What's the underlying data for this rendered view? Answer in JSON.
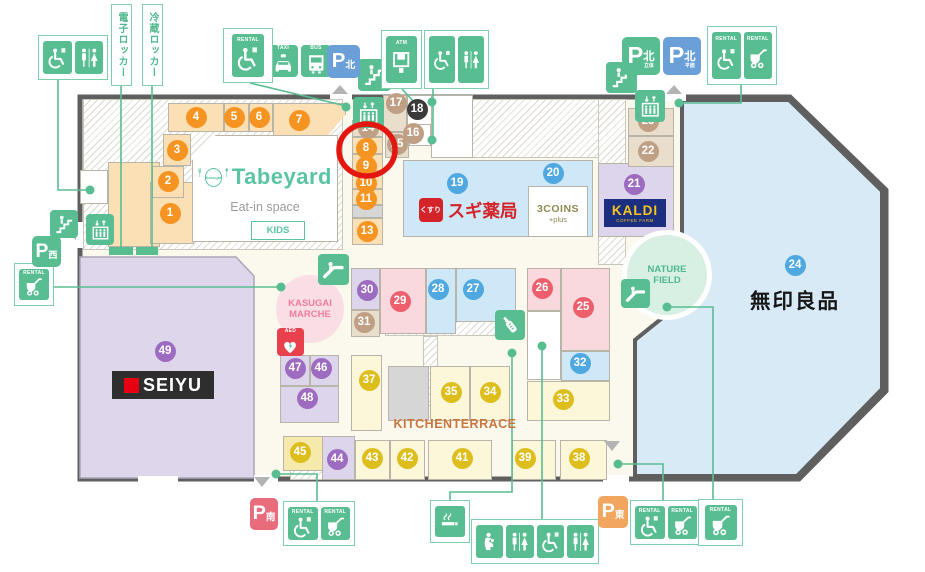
{
  "title": "Kasugai shopping center floor map",
  "highlighted_unit": "8",
  "texts": {
    "rental": "RENTAL",
    "taxi": "TAXI",
    "bus": "BUS",
    "atm": "ATM",
    "aed": "AED",
    "p": "P",
    "denshi_locker": "電子ロッカー",
    "reizo_locker": "冷蔵ロッカー",
    "kitchen_terrace": "KITCHENTERRACE",
    "muji": "無印良品",
    "marche1": "KASUGAI",
    "marche2": "MARCHE",
    "nature1": "NATURE",
    "nature2": "FIELD",
    "tabeyard_brand": "Tabeyard",
    "tabeyard_logo": "Kasugai",
    "tabeyard_sub": "Eat-in space",
    "tabeyard_kids": "KIDS",
    "sugi": "スギ薬局",
    "sugi_logo": "くすり",
    "coins": "3COINS",
    "coins_plus": "+plus",
    "kaldi": "KALDI",
    "kaldi_sub": "COFFEE FARM",
    "seiyu": "SEIYU"
  },
  "palette": {
    "green": "#59bd92",
    "greenBorder": "#7ecfae",
    "blueP": "#6a9fd8",
    "pinkP": "#e96c7c",
    "orangeP": "#f2a55f",
    "cream": "#fbf9ee",
    "wall": "#5f5f5f",
    "pe": "#fbdfb5",
    "ta": "#e9ddcc",
    "bl": "#cfe8f7",
    "pi": "#f9d9de",
    "la": "#ddd5ec",
    "ye": "#fcf7d9",
    "dy": "#f6e9ac",
    "gr": "#d6d6d6",
    "wh": "#ffffff",
    "mujiBlue": "#d7eaf6",
    "seiyuLav": "#ded7eb",
    "orange": "#f59421",
    "tan": "#bfa084",
    "blue": "#4fa8e0",
    "pink": "#ed5f6d",
    "purple": "#9d6cc0",
    "yellow": "#ddbe1c",
    "black": "#3a3a3a",
    "ringRed": "#e3170f",
    "aedRed": "#e8404d",
    "sugiRed": "#d5232a",
    "kaldiNavy": "#1b2e80",
    "kaldiYellow": "#f5c520",
    "coinsOlive": "#8f8a52",
    "kitchenBrown": "#c9773f",
    "marchePink": "#f07ca0",
    "natureGreen": "#4fb88d",
    "tabeTeal": "#5bc4a4",
    "seiyuRed": "#e60012",
    "marcheBg": "#f9dee6",
    "natureBg": "#d8efe3"
  },
  "shapes": {
    "outline": "80,97 790,97 886,190 886,391 799,479 80,479",
    "muji": "682,100 789,100 882,191 882,389 797,476 635,476 635,340 682,302",
    "seiyu": "80,257 236,257 254,276 254,478 80,478"
  },
  "units": [
    {
      "n": "1",
      "x": 170,
      "y": 213,
      "c": "orange"
    },
    {
      "n": "2",
      "x": 168,
      "y": 181,
      "c": "orange"
    },
    {
      "n": "3",
      "x": 177,
      "y": 150,
      "c": "orange"
    },
    {
      "n": "4",
      "x": 196,
      "y": 117,
      "c": "orange"
    },
    {
      "n": "5",
      "x": 234,
      "y": 117,
      "c": "orange"
    },
    {
      "n": "6",
      "x": 259,
      "y": 117,
      "c": "orange"
    },
    {
      "n": "7",
      "x": 299,
      "y": 120,
      "c": "orange"
    },
    {
      "n": "14",
      "x": 368,
      "y": 128,
      "c": "tan"
    },
    {
      "n": "8",
      "x": 366,
      "y": 148,
      "c": "orange"
    },
    {
      "n": "9",
      "x": 366,
      "y": 166,
      "c": "orange"
    },
    {
      "n": "10",
      "x": 366,
      "y": 183,
      "c": "orange"
    },
    {
      "n": "11",
      "x": 366,
      "y": 199,
      "c": "orange"
    },
    {
      "n": "13",
      "x": 367,
      "y": 231,
      "c": "orange"
    },
    {
      "n": "15",
      "x": 397,
      "y": 144,
      "c": "tan"
    },
    {
      "n": "16",
      "x": 413,
      "y": 133,
      "c": "tan"
    },
    {
      "n": "17",
      "x": 396,
      "y": 103,
      "c": "tan"
    },
    {
      "n": "18",
      "x": 417,
      "y": 109,
      "c": "black"
    },
    {
      "n": "19",
      "x": 457,
      "y": 183,
      "c": "blue"
    },
    {
      "n": "20",
      "x": 553,
      "y": 173,
      "c": "blue"
    },
    {
      "n": "21",
      "x": 634,
      "y": 184,
      "c": "purple"
    },
    {
      "n": "22",
      "x": 648,
      "y": 151,
      "c": "tan"
    },
    {
      "n": "23",
      "x": 648,
      "y": 121,
      "c": "tan"
    },
    {
      "n": "24",
      "x": 795,
      "y": 265,
      "c": "blue"
    },
    {
      "n": "25",
      "x": 583,
      "y": 307,
      "c": "pink"
    },
    {
      "n": "26",
      "x": 542,
      "y": 288,
      "c": "pink"
    },
    {
      "n": "27",
      "x": 473,
      "y": 289,
      "c": "blue"
    },
    {
      "n": "28",
      "x": 438,
      "y": 289,
      "c": "blue"
    },
    {
      "n": "29",
      "x": 400,
      "y": 301,
      "c": "pink"
    },
    {
      "n": "30",
      "x": 367,
      "y": 290,
      "c": "purple"
    },
    {
      "n": "31",
      "x": 364,
      "y": 322,
      "c": "tan"
    },
    {
      "n": "32",
      "x": 580,
      "y": 363,
      "c": "blue"
    },
    {
      "n": "33",
      "x": 563,
      "y": 399,
      "c": "yellow"
    },
    {
      "n": "34",
      "x": 490,
      "y": 392,
      "c": "yellow"
    },
    {
      "n": "35",
      "x": 451,
      "y": 392,
      "c": "yellow"
    },
    {
      "n": "37",
      "x": 369,
      "y": 380,
      "c": "yellow"
    },
    {
      "n": "38",
      "x": 579,
      "y": 458,
      "c": "yellow"
    },
    {
      "n": "39",
      "x": 525,
      "y": 458,
      "c": "yellow"
    },
    {
      "n": "41",
      "x": 462,
      "y": 458,
      "c": "yellow"
    },
    {
      "n": "42",
      "x": 407,
      "y": 458,
      "c": "yellow"
    },
    {
      "n": "43",
      "x": 372,
      "y": 458,
      "c": "yellow"
    },
    {
      "n": "44",
      "x": 337,
      "y": 459,
      "c": "purple"
    },
    {
      "n": "45",
      "x": 300,
      "y": 452,
      "c": "yellow"
    },
    {
      "n": "46",
      "x": 321,
      "y": 368,
      "c": "purple"
    },
    {
      "n": "47",
      "x": 295,
      "y": 368,
      "c": "purple"
    },
    {
      "n": "48",
      "x": 307,
      "y": 398,
      "c": "purple"
    },
    {
      "n": "49",
      "x": 165,
      "y": 351,
      "c": "purple"
    }
  ],
  "blocks": [
    [
      108,
      162,
      52,
      85,
      "pe",
      ""
    ],
    [
      150,
      182,
      44,
      62,
      "pe",
      ""
    ],
    [
      152,
      166,
      32,
      32,
      "pe",
      ""
    ],
    [
      163,
      134,
      28,
      32,
      "pe",
      ""
    ],
    [
      168,
      103,
      56,
      29,
      "pe",
      ""
    ],
    [
      224,
      103,
      25,
      29,
      "pe",
      ""
    ],
    [
      249,
      103,
      24,
      29,
      "pe",
      ""
    ],
    [
      273,
      103,
      73,
      37,
      "pe",
      "slant"
    ],
    [
      352,
      120,
      31,
      17,
      "ta",
      ""
    ],
    [
      352,
      137,
      31,
      17,
      "pe",
      ""
    ],
    [
      352,
      154,
      31,
      17,
      "pe",
      ""
    ],
    [
      352,
      171,
      31,
      18,
      "pe",
      ""
    ],
    [
      352,
      189,
      31,
      16,
      "pe",
      ""
    ],
    [
      352,
      205,
      31,
      13,
      "gr",
      ""
    ],
    [
      352,
      218,
      31,
      27,
      "pe",
      ""
    ],
    [
      383,
      95,
      24,
      37,
      "ta",
      ""
    ],
    [
      407,
      95,
      31,
      37,
      "wh",
      ""
    ],
    [
      360,
      110,
      20,
      14,
      "wh",
      ""
    ],
    [
      385,
      132,
      24,
      26,
      "ta",
      ""
    ],
    [
      409,
      124,
      22,
      22,
      "wh",
      ""
    ],
    [
      431,
      95,
      42,
      63,
      "wh",
      ""
    ],
    [
      403,
      160,
      190,
      77,
      "bl",
      ""
    ],
    [
      528,
      186,
      60,
      51,
      "wh",
      ""
    ],
    [
      598,
      163,
      76,
      74,
      "la",
      ""
    ],
    [
      628,
      108,
      46,
      28,
      "ta",
      ""
    ],
    [
      628,
      136,
      46,
      31,
      "ta",
      ""
    ],
    [
      80,
      170,
      28,
      34,
      "wh",
      ""
    ],
    [
      351,
      268,
      29,
      42,
      "la",
      ""
    ],
    [
      351,
      310,
      29,
      27,
      "ta",
      ""
    ],
    [
      380,
      268,
      46,
      66,
      "pi",
      ""
    ],
    [
      426,
      268,
      30,
      66,
      "bl",
      ""
    ],
    [
      456,
      268,
      60,
      54,
      "bl",
      ""
    ],
    [
      527,
      268,
      34,
      43,
      "pi",
      ""
    ],
    [
      561,
      268,
      49,
      83,
      "pi",
      ""
    ],
    [
      527,
      311,
      34,
      69,
      "wh",
      ""
    ],
    [
      561,
      351,
      49,
      30,
      "bl",
      ""
    ],
    [
      527,
      381,
      83,
      40,
      "ye",
      ""
    ],
    [
      351,
      355,
      31,
      76,
      "ye",
      ""
    ],
    [
      388,
      366,
      41,
      55,
      "gr",
      ""
    ],
    [
      430,
      366,
      40,
      55,
      "ye",
      ""
    ],
    [
      470,
      366,
      40,
      55,
      "ye",
      ""
    ],
    [
      283,
      436,
      47,
      35,
      "dy",
      ""
    ],
    [
      322,
      436,
      33,
      44,
      "la",
      ""
    ],
    [
      355,
      440,
      35,
      40,
      "ye",
      ""
    ],
    [
      390,
      440,
      35,
      40,
      "ye",
      ""
    ],
    [
      428,
      440,
      64,
      40,
      "ye",
      ""
    ],
    [
      512,
      440,
      44,
      40,
      "ye",
      ""
    ],
    [
      560,
      440,
      47,
      40,
      "ye",
      ""
    ],
    [
      280,
      355,
      30,
      31,
      "la",
      ""
    ],
    [
      310,
      355,
      29,
      31,
      "la",
      ""
    ],
    [
      280,
      386,
      59,
      37,
      "la",
      ""
    ],
    [
      192,
      135,
      146,
      107,
      "wh",
      "tb"
    ]
  ],
  "hatches": [
    [
      83,
      99,
      260,
      151
    ],
    [
      432,
      99,
      190,
      59
    ],
    [
      598,
      99,
      28,
      166
    ],
    [
      385,
      308,
      122,
      28
    ],
    [
      423,
      336,
      15,
      70
    ],
    [
      290,
      467,
      127,
      13
    ],
    [
      196,
      224,
      30,
      16
    ]
  ],
  "gaps": [
    [
      330,
      93,
      22,
      8
    ],
    [
      664,
      93,
      22,
      8
    ],
    [
      74,
      222,
      10,
      26
    ],
    [
      254,
      475,
      24,
      9
    ],
    [
      603,
      475,
      26,
      9
    ],
    [
      138,
      476,
      40,
      6
    ]
  ],
  "lockers": [
    [
      109,
      247,
      24,
      8
    ],
    [
      136,
      247,
      22,
      8
    ]
  ],
  "parkings": [
    {
      "x": 327,
      "y": 45,
      "w": 33,
      "h": 33,
      "bg": "#6a9fd8",
      "kanji": "北",
      "sub": ""
    },
    {
      "x": 622,
      "y": 37,
      "w": 38,
      "h": 38,
      "bg": "#59bd92",
      "kanji": "北",
      "sub": "立体"
    },
    {
      "x": 663,
      "y": 37,
      "w": 38,
      "h": 38,
      "bg": "#6a9fd8",
      "kanji": "北",
      "sub": "平面"
    },
    {
      "x": 32,
      "y": 236,
      "w": 29,
      "h": 31,
      "bg": "#59bd92",
      "kanji": "西",
      "sub": ""
    },
    {
      "x": 250,
      "y": 498,
      "w": 28,
      "h": 32,
      "bg": "#e96c7c",
      "kanji": "南",
      "sub": ""
    },
    {
      "x": 598,
      "y": 496,
      "w": 30,
      "h": 32,
      "bg": "#f2a55f",
      "kanji": "東",
      "sub": ""
    }
  ],
  "icons": [
    {
      "g": "stairs",
      "x": 358,
      "y": 59,
      "w": 33,
      "h": 32,
      "name": "stairs-icon"
    },
    {
      "g": "stairs",
      "x": 606,
      "y": 62,
      "w": 31,
      "h": 31,
      "name": "stairs-icon"
    },
    {
      "g": "stairs",
      "x": 50,
      "y": 210,
      "w": 28,
      "h": 28,
      "name": "stairs-icon"
    },
    {
      "g": "escalator",
      "x": 318,
      "y": 254,
      "w": 31,
      "h": 31,
      "name": "escalator-icon"
    },
    {
      "g": "escalator",
      "x": 621,
      "y": 279,
      "w": 29,
      "h": 29,
      "name": "escalator-icon"
    },
    {
      "g": "elevator",
      "x": 353,
      "y": 97,
      "w": 31,
      "h": 31,
      "name": "elevator-icon"
    },
    {
      "g": "elevator",
      "x": 635,
      "y": 90,
      "w": 30,
      "h": 32,
      "name": "elevator-icon"
    },
    {
      "g": "elevator",
      "x": 86,
      "y": 214,
      "w": 28,
      "h": 31,
      "name": "elevator-icon"
    },
    {
      "g": "taxi",
      "x": 268,
      "y": 45,
      "w": 30,
      "h": 32,
      "label": "taxi",
      "name": "taxi-icon"
    },
    {
      "g": "bus",
      "x": 301,
      "y": 45,
      "w": 30,
      "h": 32,
      "label": "bus",
      "name": "bus-icon"
    },
    {
      "g": "bottle",
      "x": 495,
      "y": 310,
      "w": 30,
      "h": 30,
      "name": "nursing-bottle-icon"
    }
  ],
  "groups": [
    {
      "x": 38,
      "y": 35,
      "w": 70,
      "h": 45,
      "items": [
        {
          "k": "plain",
          "g": "wheelchair"
        },
        {
          "k": "plain",
          "g": "toilets"
        }
      ]
    },
    {
      "x": 223,
      "y": 28,
      "w": 50,
      "h": 55,
      "items": [
        {
          "k": "rental",
          "g": "wheelchair"
        }
      ]
    },
    {
      "x": 381,
      "y": 30,
      "w": 41,
      "h": 59,
      "items": [
        {
          "k": "atm",
          "g": "atm"
        }
      ]
    },
    {
      "x": 424,
      "y": 30,
      "w": 65,
      "h": 59,
      "items": [
        {
          "k": "plain",
          "g": "wheelchair"
        },
        {
          "k": "plain",
          "g": "toilets"
        }
      ]
    },
    {
      "x": 707,
      "y": 26,
      "w": 70,
      "h": 59,
      "items": [
        {
          "k": "rental",
          "g": "wheelchair"
        },
        {
          "k": "rental",
          "g": "stroller"
        }
      ]
    },
    {
      "x": 14,
      "y": 263,
      "w": 40,
      "h": 43,
      "items": [
        {
          "k": "rental",
          "g": "stroller"
        }
      ]
    },
    {
      "x": 283,
      "y": 501,
      "w": 72,
      "h": 45,
      "items": [
        {
          "k": "rental",
          "g": "wheelchair"
        },
        {
          "k": "rental",
          "g": "stroller"
        }
      ]
    },
    {
      "x": 430,
      "y": 500,
      "w": 40,
      "h": 43,
      "items": [
        {
          "k": "plain",
          "g": "smoking"
        }
      ]
    },
    {
      "x": 471,
      "y": 519,
      "w": 128,
      "h": 45,
      "items": [
        {
          "k": "plain",
          "g": "nursing"
        },
        {
          "k": "plain",
          "g": "toilets"
        },
        {
          "k": "plain",
          "g": "wheelchair"
        },
        {
          "k": "plain",
          "g": "toilets"
        }
      ]
    },
    {
      "x": 630,
      "y": 500,
      "w": 72,
      "h": 45,
      "items": [
        {
          "k": "rental",
          "g": "wheelchair"
        },
        {
          "k": "rental",
          "g": "stroller"
        }
      ]
    },
    {
      "x": 698,
      "y": 499,
      "w": 45,
      "h": 47,
      "items": [
        {
          "k": "rental",
          "g": "stroller"
        }
      ]
    }
  ],
  "vlabels": [
    {
      "x": 111,
      "y": 4,
      "w": 21,
      "h": 82,
      "bind": "texts.denshi_locker",
      "name": "electronic-locker-label"
    },
    {
      "x": 142,
      "y": 4,
      "w": 21,
      "h": 82,
      "bind": "texts.reizo_locker",
      "name": "refrigerated-locker-label"
    }
  ],
  "lines": [
    [
      58,
      80,
      58,
      190,
      88,
      190
    ],
    [
      121,
      86,
      121,
      247
    ],
    [
      152,
      86,
      152,
      247
    ],
    [
      250,
      83,
      346,
      106
    ],
    [
      402,
      89,
      414,
      102
    ],
    [
      433,
      89,
      433,
      140
    ],
    [
      741,
      85,
      741,
      103,
      683,
      103
    ],
    [
      54,
      287,
      280,
      287
    ],
    [
      317,
      502,
      317,
      474,
      278,
      474
    ],
    [
      450,
      501,
      450,
      492,
      512,
      492,
      512,
      353
    ],
    [
      542,
      520,
      542,
      346
    ],
    [
      618,
      464,
      663,
      464,
      663,
      501
    ],
    [
      667,
      307,
      713,
      307,
      713,
      500
    ]
  ],
  "dots": [
    [
      90,
      190
    ],
    [
      346,
      107
    ],
    [
      432,
      102
    ],
    [
      432,
      140
    ],
    [
      679,
      103
    ],
    [
      281,
      287
    ],
    [
      667,
      307
    ],
    [
      542,
      346
    ],
    [
      512,
      353
    ],
    [
      276,
      474
    ],
    [
      618,
      464
    ]
  ],
  "triangles": [
    "332,94 348,94 340,85",
    "666,94 682,94 674,85",
    "76,224 76,240 66,232",
    "254,477 270,477 262,487",
    "604,441 620,441 612,451"
  ],
  "ring": {
    "cx": 367,
    "cy": 150,
    "rx": 28,
    "ry": 26
  }
}
